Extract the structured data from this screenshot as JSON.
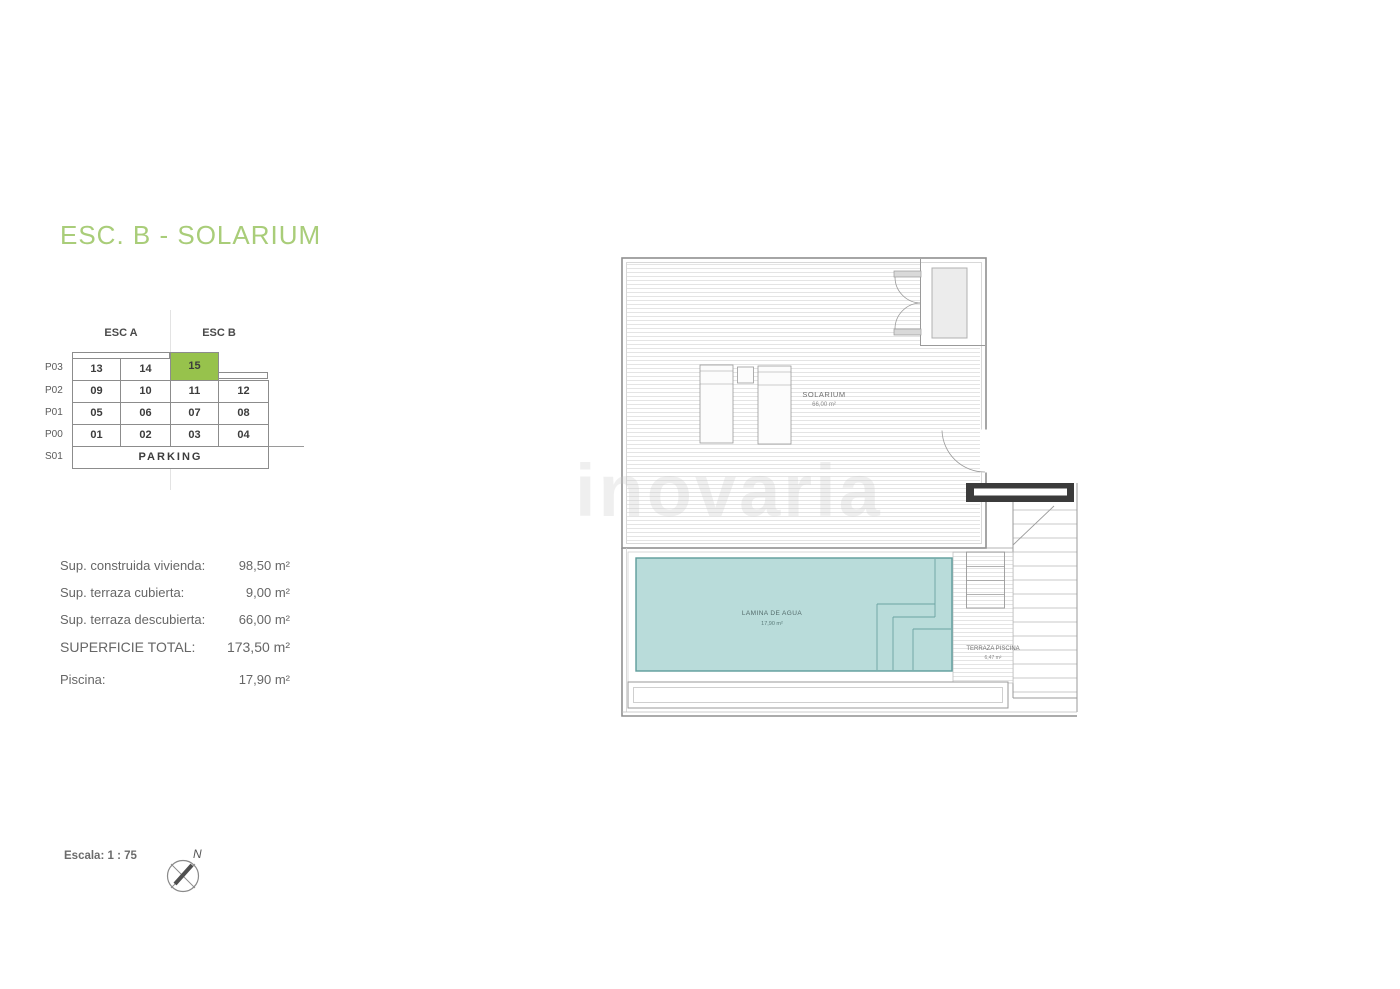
{
  "title": "ESC. B - SOLARIUM",
  "unit_table": {
    "headers": [
      "ESC A",
      "ESC B"
    ],
    "row_labels": [
      "P03",
      "P02",
      "P01",
      "P00",
      "S01"
    ],
    "highlighted_unit": "15",
    "rows": [
      {
        "label": "P03",
        "cells": [
          "13",
          "14",
          "15"
        ]
      },
      {
        "label": "P02",
        "cells": [
          "09",
          "10",
          "11",
          "12"
        ]
      },
      {
        "label": "P01",
        "cells": [
          "05",
          "06",
          "07",
          "08"
        ]
      },
      {
        "label": "P00",
        "cells": [
          "01",
          "02",
          "03",
          "04"
        ]
      },
      {
        "label": "S01",
        "cells": [
          "PARKING"
        ]
      }
    ]
  },
  "areas": {
    "rows": [
      {
        "label": "Sup. construida vivienda:",
        "value": "98,50 m²"
      },
      {
        "label": "Sup. terraza cubierta:",
        "value": "9,00 m²"
      },
      {
        "label": "Sup. terraza descubierta:",
        "value": "66,00 m²"
      },
      {
        "label": "SUPERFICIE TOTAL:",
        "value": "173,50 m²"
      },
      {
        "label": "Piscina:",
        "value": "17,90 m²"
      }
    ]
  },
  "plan": {
    "room_label": "SOLARIUM",
    "room_area": "66,00 m²",
    "pool_label": "LAMINA DE AGUA",
    "pool_area": "17,90 m²",
    "terrace_label": "TERRAZA PISCINA",
    "terrace_area": "6,47 m²"
  },
  "footer": {
    "scale_label": "Escala: 1 : 75",
    "compass_north": "N"
  },
  "watermark": "inovaria",
  "colors": {
    "title_green": "#a9cd79",
    "highlight_green": "#97c24c",
    "pool_fill": "#b9dcda",
    "pool_border": "#5e9c9b"
  }
}
